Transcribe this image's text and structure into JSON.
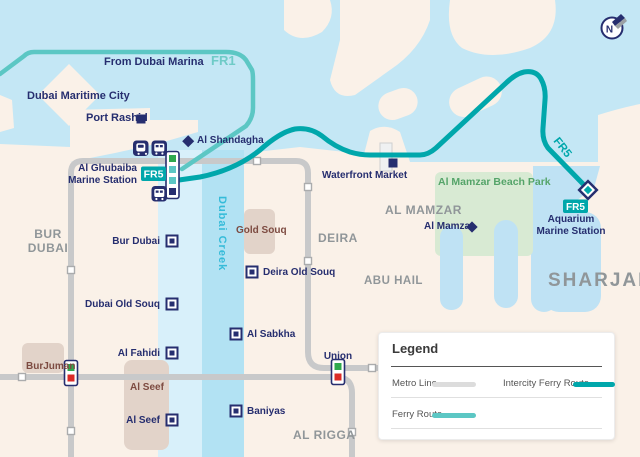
{
  "labels": {
    "from_dubai_marina": "From Dubai Marina",
    "fr1": "FR1",
    "dubai_maritime_city": "Dubai Maritime City",
    "port_rashid": "Port Rashid",
    "al_shandagha": "Al Shandagha",
    "al_ghubaiba": "Al Ghubaiba\nMarine Station",
    "fr5_ghubaiba": "FR5",
    "waterfront_market": "Waterfront Market",
    "al_mamzar_beach_park": "Al Mamzar Beach Park",
    "al_mamzar_area": "AL MAMZAR",
    "al_mamzar": "Al Mamzar",
    "fr5_route": "FR5",
    "fr5_aquarium": "FR5",
    "aquarium": "Aquarium\nMarine Station",
    "sharjah": "SHARJAH",
    "bur_dubai_area": "BUR\nDUBAI",
    "deira": "DEIRA",
    "abu_hail": "ABU HAIL",
    "al_rigga": "AL RIGGA",
    "gold_souq": "Gold Souq",
    "al_seef_area": "Al Seef",
    "burjuman": "BurJuman",
    "dubai_creek": "Dubai Creek",
    "compass_n": "N"
  },
  "stations": {
    "bur_dubai": "Bur Dubai",
    "deira_old_souq": "Deira Old Souq",
    "dubai_old_souq": "Dubai Old Souq",
    "al_sabkha": "Al Sabkha",
    "al_fahidi": "Al Fahidi",
    "al_seef": "Al Seef",
    "baniyas": "Baniyas",
    "union": "Union"
  },
  "legend": {
    "title": "Legend",
    "items": [
      {
        "label": "Metro Line"
      },
      {
        "label": "Intercity Ferry Route"
      },
      {
        "label": "Ferry Route"
      }
    ]
  },
  "colors": {
    "sea": "#C4E7F5",
    "land": "#FAF1E8",
    "creek_light": "#D8F0FA",
    "creek_medium": "#B2E2F3",
    "park_green": "#D8EAD3",
    "lagoon": "#BFE2F4",
    "souq_patch": "#E2D3C9",
    "metro_gray": "#C8C9CA",
    "ferry_route_teal": "#5CC7C4",
    "intercity_teal": "#00A7AB",
    "navy": "#262E6F",
    "interchange_green": "#2FA84D",
    "interchange_red": "#DB2B27",
    "area_label_gray": "#909699",
    "souq_label_maroon": "#7D4B41"
  }
}
